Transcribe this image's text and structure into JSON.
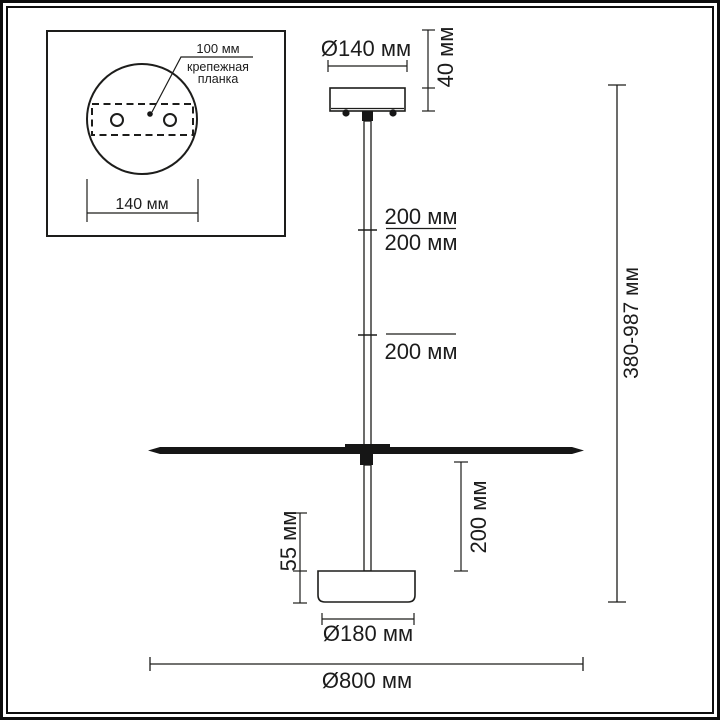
{
  "inset": {
    "hole_spacing_label": "100 мм",
    "bracket_label_line1": "крепежная",
    "bracket_label_line2": "планка",
    "canopy_diameter_label": "140 мм"
  },
  "dimensions": {
    "canopy_diameter": "Ø140 мм",
    "canopy_height": "40 мм",
    "rod_segment_1": "200 мм",
    "rod_segment_2": "200 мм",
    "rod_segment_3": "200 мм",
    "shade_to_base_drop": "200 мм",
    "base_height": "55 мм",
    "base_diameter": "Ø180 мм",
    "shade_diameter": "Ø800 мм",
    "overall_height": "380-987 мм"
  },
  "colors": {
    "line": "#1d1d1b",
    "fill": "#161616",
    "text": "#1c1c1c",
    "background": "#ffffff"
  }
}
